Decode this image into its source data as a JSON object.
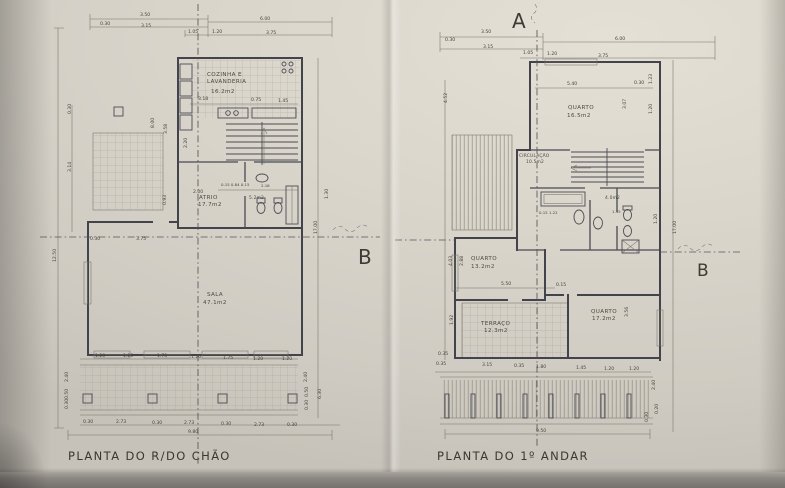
{
  "photo": {
    "paper_color": "#dad6cc",
    "table_color": "#7d7974",
    "line_color": "#43434b"
  },
  "markers": {
    "a": "A",
    "b_left": "B",
    "b_right": "B"
  },
  "left": {
    "title": "PLANTA DO R/DO CHÃO",
    "rooms": {
      "cozinha": {
        "name_line1": "COZINHA E",
        "name_line2": "LAVANDERIA",
        "area": "16.2m2"
      },
      "atrio": {
        "name": "ATRIO",
        "area": "17.7m2"
      },
      "wc": {
        "area": "5.2m2"
      },
      "sala": {
        "name": "SALA",
        "area": "47.1m2"
      }
    },
    "dims_top": [
      "3.50",
      "0.30",
      "3.15",
      "6.00",
      "1.05",
      "1.20",
      "3.75"
    ],
    "dims_kitchen": [
      "3.18",
      "0.75",
      "1.45"
    ],
    "dims_mid": [
      "2.00",
      "0.15 0.84 0.15",
      "2.16"
    ],
    "dims_left": [
      "12.50",
      "0.30",
      "3.14",
      "8.00",
      "3.58",
      "2.20",
      "0.93",
      "3.75",
      "0.30"
    ],
    "dims_right": [
      "17.00",
      "1.30",
      "2.40",
      "6.30",
      "0.50",
      "0.30"
    ],
    "dims_left_bottom": [
      "2.40",
      "0.50",
      "0.30"
    ],
    "dims_row1": [
      "1.20",
      "1.20",
      "1.75",
      "1.20",
      "1.75",
      "1.20",
      "1.20"
    ],
    "dims_row2": [
      "0.30",
      "2.73",
      "0.30",
      "2.73",
      "0.30",
      "2.73",
      "0.30"
    ],
    "total_width": "9.80"
  },
  "right": {
    "title": "PLANTA DO 1º ANDAR",
    "rooms": {
      "quarto1": {
        "name": "QUARTO",
        "area": "16.5m2"
      },
      "circulacao": {
        "name": "CIRCULAÇÃO",
        "area": "10.5m2"
      },
      "wc": {
        "area": "4.0m2"
      },
      "quarto2": {
        "name": "QUARTO",
        "area": "13.2m2"
      },
      "terraco": {
        "name": "TERRAÇO",
        "area": "12.3m2"
      },
      "quarto3": {
        "name": "QUARTO",
        "area": "17.2m2"
      }
    },
    "dims_top": [
      "3.50",
      "0.30",
      "3.15",
      "6.00",
      "1.05",
      "1.20",
      "3.75"
    ],
    "dims_quarto1": [
      "5.40",
      "0.30",
      "1.23",
      "3.07",
      "1.20"
    ],
    "dims_bath": [
      "0.15 1.22",
      "1.35",
      "1.20"
    ],
    "dims_quarto2": [
      "2.88",
      "5.50",
      "0.15"
    ],
    "dims_quarto3": [
      "3.56"
    ],
    "dims_left": [
      "4.52",
      "4.03",
      "1.92",
      "0.35"
    ],
    "dims_right": [
      "17.00",
      "2.40",
      "0.30",
      "0.20"
    ],
    "dims_bottom": [
      "0.35",
      "3.15",
      "0.35",
      "1.80",
      "1.45",
      "1.20",
      "1.20"
    ],
    "total_width": "9.50"
  }
}
